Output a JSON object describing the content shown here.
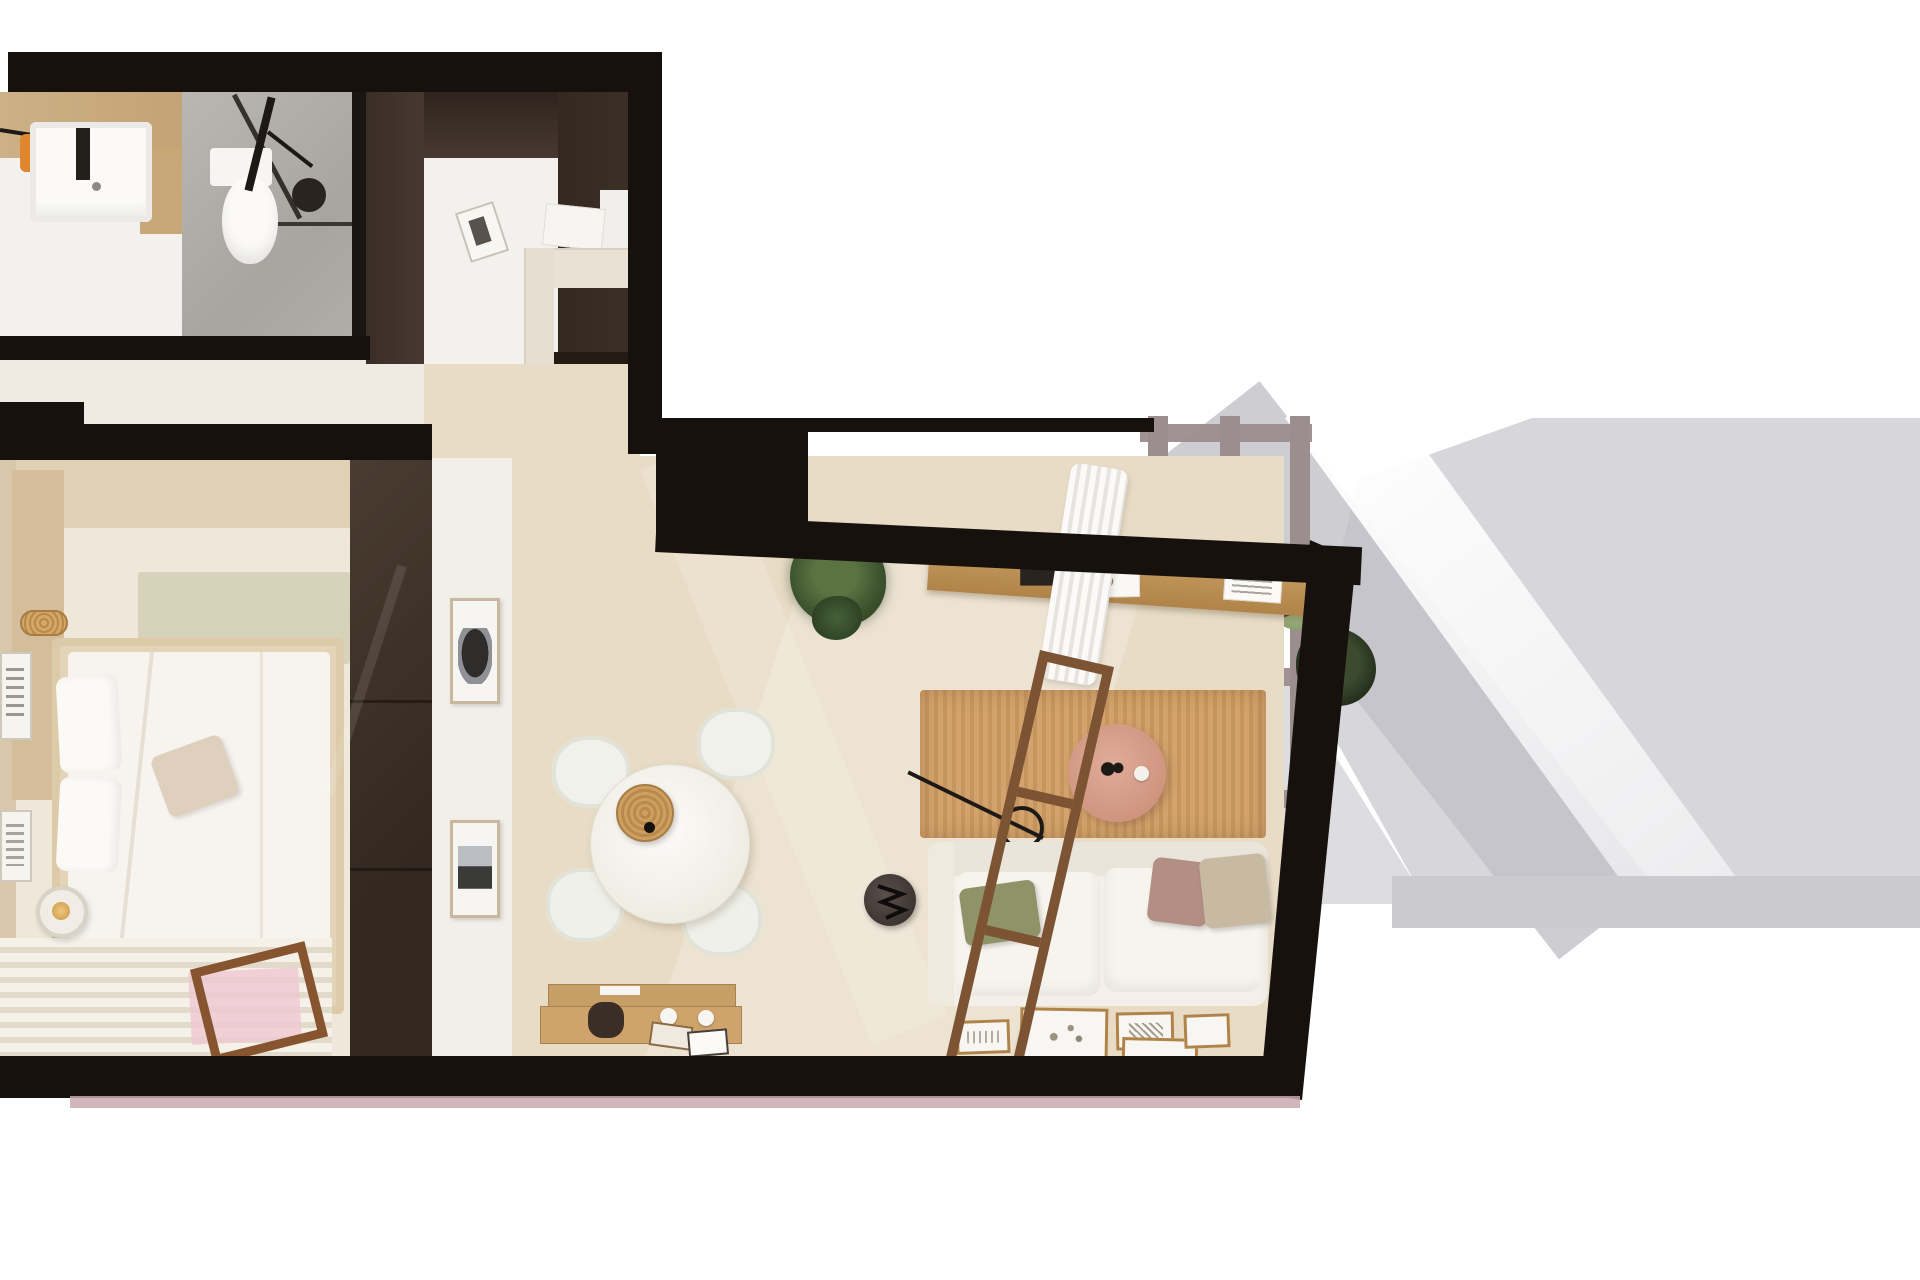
{
  "app": {
    "type": "3d-top-down-apartment-floor-plan-render",
    "visible_text": "none"
  },
  "colors": {
    "bg": "#ffffff",
    "wall": "#17110d",
    "wallsoft": "#241b15",
    "brown-wall": "#473931",
    "kitchen": "#3c2f26",
    "wardrobe": "#3e3229",
    "floor-beige": "#e8dcc6",
    "floor-light": "#f3f1ed",
    "floor-bedroom": "#efe8da",
    "wallband": "#e0d0b4",
    "wood-light": "#d3bd9b",
    "wood-band": "#c9ac80",
    "rug-jute": "#cda06b",
    "rug-jute2": "#c2935c",
    "rug-sage": "#d6d3ba",
    "rug-stripe1": "#f5f1e8",
    "rug-stripe2": "#e2dacb",
    "pink": "#eec9d2",
    "baseline": "#c9a9b0",
    "sofa": "#f4f0e9",
    "cushion": "#f7f4ee",
    "pillow-green": "#8f9468",
    "pillow-mauve": "#b28e83",
    "pillow-tan": "#c8b9a3",
    "terracotta": "#d79e8c",
    "rattan": "#c6995c",
    "desk-wood": "#bc9257",
    "frame-wood": "#b08448",
    "pergola": "#9c8d8e",
    "terrace": "#d7d6da",
    "terrace-sh": "#c2c1c7",
    "terrace-dk": "#cbcacf",
    "plant": "#4c6433",
    "plant-dk": "#33482a",
    "plant-darkest": "#222d1c",
    "bush": "#8aa06c",
    "shower": "#b5b1ac",
    "white": "#f8f6f2",
    "bench": "#86552f",
    "ladder": "#7c5434"
  },
  "rooms": [
    {
      "name": "bathroom",
      "items": [
        "towel-rail",
        "orange-towels",
        "sink-vanity",
        "toilet",
        "walk-in-shower",
        "glass-partition",
        "shower-head"
      ]
    },
    {
      "name": "hallway",
      "items": [
        "leaning-picture",
        "white-bench",
        "corner-counter"
      ]
    },
    {
      "name": "kitchen",
      "items": [
        "tall-dark-cabinets",
        "white-cabinet"
      ]
    },
    {
      "name": "bedroom",
      "items": [
        "double-bed",
        "pillows",
        "headboard",
        "rattan-wall-lamp",
        "sage-rug",
        "striped-rug",
        "pink-accent-rug",
        "wood-bench",
        "round-table-lamp",
        "wall-frames",
        "wardrobe"
      ]
    },
    {
      "name": "living-dining-room",
      "items": [
        "round-dining-table",
        "rattan-pendant-lamp",
        "four-chairs",
        "potted-plant",
        "wall-desk",
        "window",
        "curtain",
        "jute-rug",
        "terracotta-coffee-table",
        "arc-floor-lamp",
        "black-side-table",
        "white-sofa",
        "sofa-pillows",
        "leaning-art-frames",
        "toy-sideboard",
        "wood-ladder-shelf",
        "gallery-frames-on-wall"
      ]
    },
    {
      "name": "terrace",
      "items": [
        "pergola-lattice",
        "ring-planter",
        "green-plants",
        "dark-potted-plant",
        "wire-chair",
        "stone-floor",
        "sun-shadow"
      ]
    }
  ]
}
